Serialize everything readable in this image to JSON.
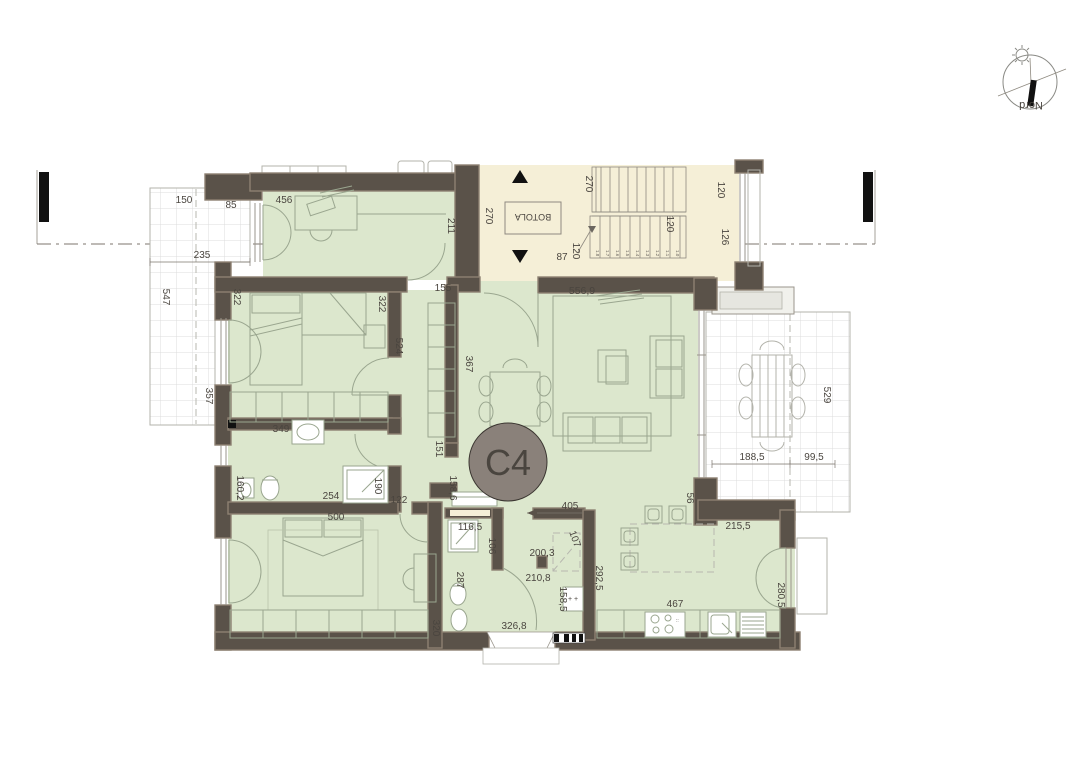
{
  "unit": {
    "label": "C4"
  },
  "compass": {
    "label": "Nord"
  },
  "stair": {
    "hatch_label": "BOTOLA",
    "dim_270_left": "270",
    "dim_270_top": "270",
    "dim_120_mid": "120",
    "dim_120_bottom": "120",
    "dim_87": "87",
    "dim_120_window": "120",
    "dim_126_window": "126",
    "treads": [
      "1.8",
      "1.7",
      "1.6",
      "1.5",
      "1.4",
      "1.3",
      "1.2",
      "1.1",
      "1.0"
    ]
  },
  "left_terrace": {
    "dim_150": "150",
    "dim_85": "85",
    "dim_235": "235",
    "dim_547": "547",
    "dim_357": "357"
  },
  "study": {
    "dim_456": "456",
    "dim_211": "211"
  },
  "bedroom1": {
    "dim_322_left": "322",
    "dim_322_right": "322",
    "dim_524": "524",
    "dim_349": "349"
  },
  "corridor": {
    "dim_155": "155",
    "dim_367": "367",
    "dim_151": "151",
    "dim_158_6": "158,6"
  },
  "living": {
    "dim_556_9": "556,9",
    "dim_56": "56"
  },
  "right_terrace": {
    "dim_529": "529",
    "dim_188_5": "188,5",
    "dim_99_5": "99,5"
  },
  "bath1": {
    "dim_160_2": "160,2",
    "dim_254": "254",
    "dim_190": "190",
    "dim_122": "122"
  },
  "bedroom2": {
    "dim_500": "500",
    "dim_320": "320"
  },
  "bath2": {
    "dim_116_5": "116,5",
    "dim_106": "106",
    "dim_287": "287",
    "dim_320": "320",
    "dim_326_8": "326,8"
  },
  "hall": {
    "dim_405": "405",
    "dim_200_3": "200,3",
    "dim_210_8": "210,8",
    "dim_107": "107",
    "dim_292_5": "292,5",
    "dim_158_5": "158,5"
  },
  "kitchen": {
    "dim_215_5": "215,5",
    "dim_467": "467",
    "dim_280_5": "280,5"
  },
  "colors": {
    "wall": "#5a5249",
    "room_fill": "#dce7cd",
    "stair_fill": "#f5efd7",
    "badge_fill": "#8a817a"
  }
}
